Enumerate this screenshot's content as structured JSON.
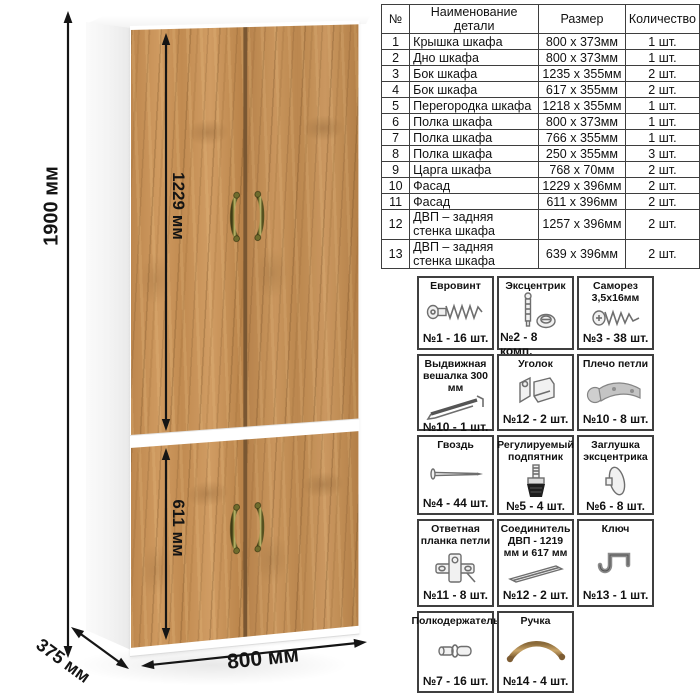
{
  "dimensions": {
    "height": "1900 мм",
    "upper_door_height": "1229 мм",
    "lower_door_height": "611 мм",
    "width": "800 мм",
    "depth": "375 мм"
  },
  "parts_table": {
    "headers": [
      "№",
      "Наименование детали",
      "Размер",
      "Количество"
    ],
    "rows": [
      {
        "num": "1",
        "name": "Крышка шкафа",
        "size": "800 х 373мм",
        "qty": "1 шт."
      },
      {
        "num": "2",
        "name": "Дно шкафа",
        "size": "800 х 373мм",
        "qty": "1 шт."
      },
      {
        "num": "3",
        "name": "Бок шкафа",
        "size": "1235 х 355мм",
        "qty": "2 шт."
      },
      {
        "num": "4",
        "name": "Бок шкафа",
        "size": "617 х 355мм",
        "qty": "2 шт."
      },
      {
        "num": "5",
        "name": "Перегородка шкафа",
        "size": "1218 х 355мм",
        "qty": "1 шт."
      },
      {
        "num": "6",
        "name": "Полка шкафа",
        "size": "800 х 373мм",
        "qty": "1 шт."
      },
      {
        "num": "7",
        "name": "Полка шкафа",
        "size": "766 х 355мм",
        "qty": "1 шт."
      },
      {
        "num": "8",
        "name": "Полка шкафа",
        "size": "250 х 355мм",
        "qty": "3 шт."
      },
      {
        "num": "9",
        "name": "Царга шкафа",
        "size": "768 х 70мм",
        "qty": "2 шт."
      },
      {
        "num": "10",
        "name": "Фасад",
        "size": "1229 х 396мм",
        "qty": "2 шт."
      },
      {
        "num": "11",
        "name": "Фасад",
        "size": "611 х 396мм",
        "qty": "2 шт."
      },
      {
        "num": "12",
        "name": "ДВП – задняя стенка шкафа",
        "size": "1257 х 396мм",
        "qty": "2 шт."
      },
      {
        "num": "13",
        "name": "ДВП – задняя стенка шкафа",
        "size": "639 х 396мм",
        "qty": "2 шт."
      }
    ]
  },
  "hardware": [
    {
      "title": "Евровинт",
      "qty": "№1 - 16 шт.",
      "icon": "euro-screw-icon"
    },
    {
      "title": "Эксцентрик",
      "qty": "№2 - 8 комп.",
      "icon": "eccentric-cam-icon"
    },
    {
      "title": "Саморез 3,5х16мм",
      "qty": "№3 - 38 шт.",
      "icon": "self-tapping-screw-icon"
    },
    {
      "title": "Выдвижная вешалка 300 мм",
      "qty": "№10 - 1 шт.",
      "icon": "pullout-hanger-icon"
    },
    {
      "title": "Уголок",
      "qty": "№12 - 2 шт.",
      "icon": "corner-bracket-icon"
    },
    {
      "title": "Плечо петли",
      "qty": "№10 - 8 шт.",
      "icon": "hinge-arm-icon"
    },
    {
      "title": "Гвоздь",
      "qty": "№4 - 44 шт.",
      "icon": "nail-icon"
    },
    {
      "title": "Регулируемый подпятник",
      "qty": "№5 - 4 шт.",
      "icon": "adjustable-foot-icon"
    },
    {
      "title": "Заглушка эксцентрика",
      "qty": "№6 - 8 шт.",
      "icon": "cam-cover-icon"
    },
    {
      "title": "Ответная планка петли",
      "qty": "№11 - 8 шт.",
      "icon": "hinge-plate-icon"
    },
    {
      "title": "Соединитель ДВП - 1219 мм и 617 мм",
      "qty": "№12 - 2 шт.",
      "icon": "hdf-connector-icon"
    },
    {
      "title": "Ключ",
      "qty": "№13 - 1 шт.",
      "icon": "hex-key-icon"
    },
    {
      "title": "Полкодержатель",
      "qty": "№7 - 16 шт.",
      "icon": "shelf-pin-icon"
    },
    {
      "title": "Ручка",
      "qty": "№14 - 4 шт.",
      "icon": "handle-icon"
    }
  ],
  "colors": {
    "wood": "#c28c54",
    "wood_dark": "#7a5732",
    "carcass": "#ffffff",
    "arrow": "#141414",
    "table_border": "#3e3e3e",
    "handle_olive": "#8f8c3e"
  }
}
